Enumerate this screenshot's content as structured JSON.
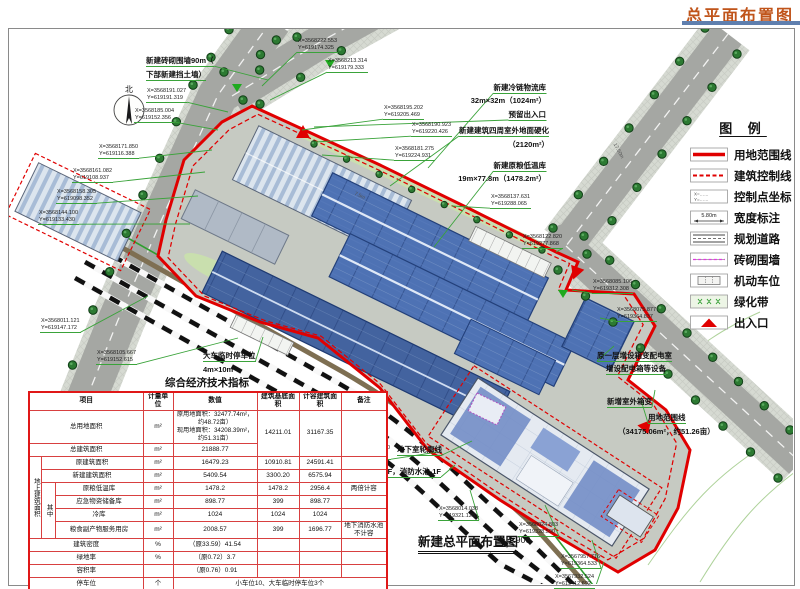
{
  "page_title": "总平面布置图",
  "compass": "北",
  "drawing": {
    "title": "新建总平面布置图",
    "scale": "1:900"
  },
  "colors": {
    "boundary": "#e00000",
    "leader": "#3aa33a",
    "title": "#c0541a"
  },
  "legend": {
    "title": "图  例",
    "width_sample": "5.80m",
    "ctrl_x": "X=……",
    "ctrl_y": "Y=……",
    "items": [
      {
        "label": "用地范围线"
      },
      {
        "label": "建筑控制线"
      },
      {
        "label": "控制点坐标"
      },
      {
        "label": "宽度标注"
      },
      {
        "label": "规划道路"
      },
      {
        "label": "砖砌围墙"
      },
      {
        "label": "机动车位"
      },
      {
        "label": "绿化带"
      },
      {
        "label": "出入口"
      }
    ]
  },
  "table": {
    "title": "综合经济技术指标",
    "headers": [
      "项目",
      "计量单位",
      "数值",
      "建筑基底面积",
      "计容建筑面积",
      "备注"
    ],
    "rows": {
      "group_label": "地上建筑面积",
      "among_label": "其中",
      "total_land": {
        "label": "总用地面积",
        "unit": "m²",
        "value": "原用地面积：32477.74m²，\n约48.72亩）\n现用地面积：34208.39m²，\n约51.31亩）",
        "base": "14211.01",
        "capacity": "31167.35",
        "note": ""
      },
      "total_building": {
        "label": "总建筑面积",
        "unit": "m²",
        "value": "21888.77"
      },
      "original_building": {
        "label": "原建筑面积",
        "unit": "m²",
        "value": "16479.23",
        "base": "10910.81",
        "capacity": "24591.41",
        "note": ""
      },
      "new_building": {
        "label": "新建建筑面积",
        "unit": "m²",
        "value": "5409.54",
        "base": "3300.20",
        "capacity": "6575.94",
        "note": ""
      },
      "grain_cold": {
        "label": "原粮低温库",
        "unit": "m²",
        "value": "1478.2",
        "base": "1478.2",
        "capacity": "2956.4",
        "note": "两倍计容"
      },
      "emergency": {
        "label": "应急物资储备库",
        "unit": "m²",
        "value": "898.77",
        "base": "399",
        "capacity": "898.77",
        "note": ""
      },
      "cold_storage": {
        "label": "冷库",
        "unit": "m²",
        "value": "1024",
        "base": "1024",
        "capacity": "1024",
        "note": ""
      },
      "byproduct": {
        "label": "粮食副产物服务用房",
        "unit": "m²",
        "value": "2008.57",
        "base": "399",
        "capacity": "1696.77",
        "note": "地下消防水池不计容"
      },
      "density": {
        "label": "建筑密度",
        "unit": "%",
        "value": "（原33.59）41.54"
      },
      "green_rate": {
        "label": "绿地率",
        "unit": "%",
        "value": "（原0.72）3.7"
      },
      "plot_ratio": {
        "label": "容积率",
        "unit": "",
        "value": "（原0.76）0.91"
      },
      "parking": {
        "label": "停车位",
        "unit": "个",
        "value": "小车位10、大车临时停车位3个"
      }
    }
  },
  "annotations": [
    {
      "t": "新建砖砌围墙90m（",
      "x": 146,
      "y": 56,
      "u": 1,
      "tx": 268,
      "ty": 80
    },
    {
      "t": "下部新建挡土墙）",
      "x": 146,
      "y": 70,
      "u": 1
    },
    {
      "t": "新建冷链物流库",
      "r": 546,
      "y": 83,
      "u": 1,
      "tx": 428,
      "ty": 168
    },
    {
      "t": "32m×32m（1024m²）",
      "r": 546,
      "y": 96
    },
    {
      "t": "预留出入口",
      "r": 546,
      "y": 110,
      "u": 1,
      "tx": 314,
      "ty": 127
    },
    {
      "t": "新建建筑四周室外地面硬化",
      "r": 549,
      "y": 126,
      "u": 1,
      "tx": 390,
      "ty": 186
    },
    {
      "t": "（2120m²）",
      "r": 549,
      "y": 140
    },
    {
      "t": "新建原粮低温库",
      "r": 546,
      "y": 161,
      "u": 1,
      "tx": 434,
      "ty": 247
    },
    {
      "t": "19m×77.8m（1478.2m²）",
      "r": 546,
      "y": 174
    },
    {
      "t": "大车临时停车位",
      "x": 203,
      "y": 351,
      "u": 1,
      "tx": 263,
      "ty": 337
    },
    {
      "t": "4m×10m",
      "x": 203,
      "y": 365
    },
    {
      "t": "原一层增设箱变配电室",
      "x": 597,
      "y": 351,
      "u": 1,
      "tx": 614,
      "ty": 346
    },
    {
      "t": "增设配电箱等设备",
      "x": 606,
      "y": 364,
      "u": 1
    },
    {
      "t": "新增室外箱变",
      "x": 607,
      "y": 397,
      "u": 1,
      "tx": 655,
      "ty": 390
    },
    {
      "t": "用地范围线",
      "x": 648,
      "y": 413,
      "u": 1,
      "tx": 641,
      "ty": 400
    },
    {
      "t": "（34175.06m²，约51.26亩）",
      "x": 618,
      "y": 427
    },
    {
      "t": "地下室轮廓线",
      "x": 397,
      "y": 445,
      "u": 1,
      "tx": 472,
      "ty": 441
    },
    {
      "t": "粮食副产物服务用房4F，消防水池-1F",
      "x": 316,
      "y": 467,
      "u": 1,
      "tx": 455,
      "ty": 465
    },
    {
      "t": "（2008.57m²）",
      "x": 329,
      "y": 481
    },
    {
      "t": "7.5m",
      "x": 354,
      "y": 193,
      "rot": 26,
      "size": 5
    },
    {
      "t": "17.50m",
      "x": 610,
      "y": 148,
      "rot": 62,
      "size": 5
    }
  ],
  "coord_labels": [
    {
      "X": "X=3568222.553",
      "Y": "Y=619174.325",
      "x": 297,
      "y": 38,
      "tx": 262,
      "ty": 86
    },
    {
      "X": "X=3568213.314",
      "Y": "Y=619179.333",
      "x": 327,
      "y": 58,
      "tx": 270,
      "ty": 100
    },
    {
      "X": "X=3568195.202",
      "Y": "Y=619205.469",
      "x": 383,
      "y": 105,
      "tx": 302,
      "ty": 130
    },
    {
      "X": "X=3568190.923",
      "Y": "Y=619220.426",
      "x": 411,
      "y": 122,
      "tx": 315,
      "ty": 142
    },
    {
      "X": "X=3568181.275",
      "Y": "Y=619224.931",
      "x": 394,
      "y": 146,
      "tx": 322,
      "ty": 155
    },
    {
      "X": "X=3568137.631",
      "Y": "Y=619288.065",
      "x": 490,
      "y": 194,
      "tx": 452,
      "ty": 206
    },
    {
      "X": "X=3568122.820",
      "Y": "Y=619277.868",
      "x": 522,
      "y": 234,
      "tx": 556,
      "ty": 252
    },
    {
      "X": "X=3568085.106",
      "Y": "Y=619312.308",
      "x": 592,
      "y": 279,
      "tx": 572,
      "ty": 290
    },
    {
      "X": "X=3568075.877",
      "Y": "Y=619364.837",
      "x": 616,
      "y": 307,
      "tx": 600,
      "ty": 318
    },
    {
      "X": "X=3568191.027",
      "Y": "Y=619191.319",
      "x": 146,
      "y": 88,
      "tx": 228,
      "ty": 112
    },
    {
      "X": "X=3568185.004",
      "Y": "Y=619152.356",
      "x": 134,
      "y": 108,
      "tx": 218,
      "ty": 130
    },
    {
      "X": "X=3568171.850",
      "Y": "Y=619116.388",
      "x": 98,
      "y": 144,
      "tx": 212,
      "ty": 150
    },
    {
      "X": "X=3568161.082",
      "Y": "Y=619108.937",
      "x": 72,
      "y": 168,
      "tx": 205,
      "ty": 172
    },
    {
      "X": "X=3568158.305",
      "Y": "Y=619098.352",
      "x": 56,
      "y": 189,
      "tx": 198,
      "ty": 196
    },
    {
      "X": "X=3568144.100",
      "Y": "Y=619133.430",
      "x": 38,
      "y": 210,
      "tx": 190,
      "ty": 224
    },
    {
      "X": "X=3568011.121",
      "Y": "Y=619147.172",
      "x": 40,
      "y": 318,
      "tx": 148,
      "ty": 296
    },
    {
      "X": "X=3568105.667",
      "Y": "Y=619152.615",
      "x": 96,
      "y": 350,
      "tx": 238,
      "ty": 338
    },
    {
      "X": "X=3568031.010",
      "Y": "Y=619296.634",
      "x": 350,
      "y": 445,
      "tx": 438,
      "ty": 452
    },
    {
      "X": "X=3568014.038",
      "Y": "Y=619321.128",
      "x": 438,
      "y": 506,
      "tx": 470,
      "ty": 490
    },
    {
      "X": "X=3568024.803",
      "Y": "Y=619328.590",
      "x": 518,
      "y": 522,
      "tx": 545,
      "ty": 505
    },
    {
      "X": "X=3567957.716",
      "Y": "Y=619364.533",
      "x": 560,
      "y": 554,
      "tx": 592,
      "ty": 540
    },
    {
      "X": "X=3567932.524",
      "Y": "Y=619412.692",
      "x": 554,
      "y": 574,
      "tx": 604,
      "ty": 562
    }
  ]
}
